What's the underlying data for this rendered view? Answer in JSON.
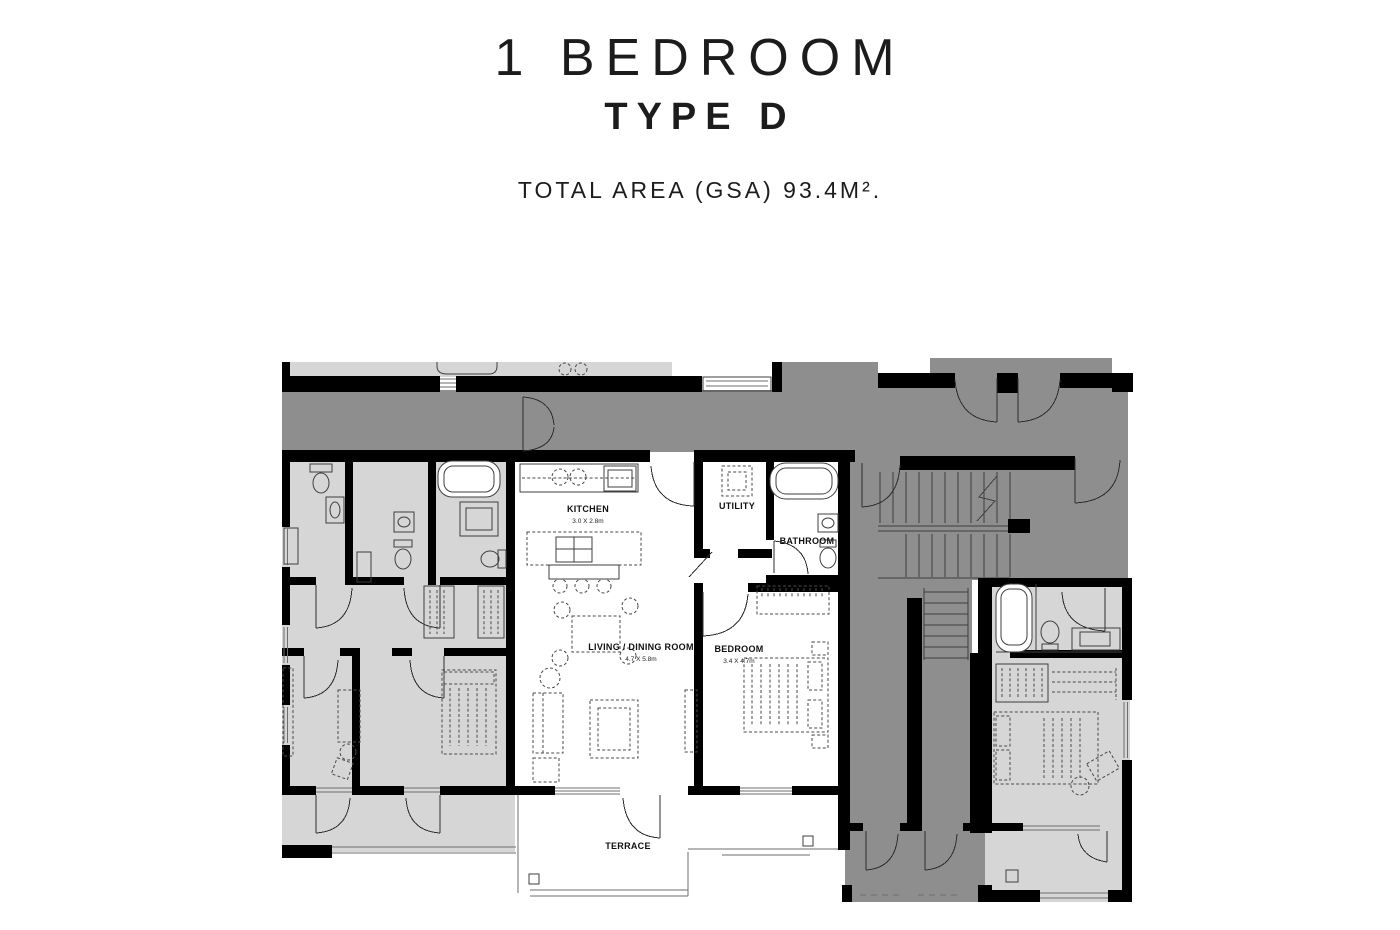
{
  "header": {
    "title": "1 BEDROOM",
    "subtitle": "TYPE D",
    "area_note": "TOTAL AREA (GSA) 93.4M²."
  },
  "plan": {
    "rooms": {
      "kitchen": {
        "name": "KITCHEN",
        "dims": "3.0 X 2.8m"
      },
      "utility": {
        "name": "UTILITY"
      },
      "bathroom": {
        "name": "BATHROOM"
      },
      "living": {
        "name": "LIVING / DINING ROOM",
        "dims": "4.7 X 5.8m"
      },
      "bedroom": {
        "name": "BEDROOM",
        "dims": "3.4 X 4.7m"
      },
      "terrace": {
        "name": "TERRACE"
      }
    },
    "colors": {
      "wall": "#000000",
      "corridor": "#8e8e8e",
      "neighbor": "#d6d6d6",
      "unit": "#ffffff",
      "line": "#3f3f3f",
      "ink": "#1c1c1c"
    }
  }
}
